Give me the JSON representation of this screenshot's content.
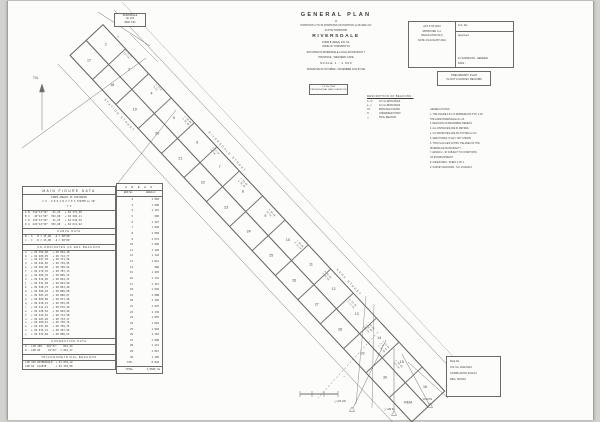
{
  "colors": {
    "ink": "#3a3a3a",
    "line": "#6b6b66",
    "paper": "#fcfcfa"
  },
  "title_block": {
    "main": "GENERAL  PLAN",
    "of": "of",
    "portions": "PORTIONS 2 TO 30 (PORTIONS OF PORTION 1) OF ERF 217",
    "in_the": "IN THE TOWNSHIP",
    "name": "RIVERSDALE",
    "sub1": "FORM B (AREA)  D.B. No.",
    "sub2": "ZONE OF TOWNSHIP 64",
    "situated": "SITUATED IN RIVERSDALE LOCAL MUNICIPALITY",
    "province": "PROVINCE :  WESTERN CAPE",
    "scale": "SCALE  1 : 1 000",
    "surveyed": "SURVEYED IN OCTOBER - NOVEMBER 2011 BY ME"
  },
  "surveyor_box": {
    "lines": [
      "L.S. No. 8106",
      "PROFESSIONAL LAND SURVEYOR"
    ]
  },
  "approval_box": {
    "left_lines": [
      "ACT 9 OF 2010",
      "APPROVED i.t.o.",
      "REGULATION 5(1)",
      "DATE: 19 AUGUST 2011"
    ],
    "sg_label": "S.G. No.",
    "approved_label": "Approved",
    "for_label": "for  SURVEYOR - GENERAL",
    "date_label": "DATE :"
  },
  "preliminary_box": {
    "lines": [
      "PRELIMINARY PLAN",
      "IS NOT A SURVEY RECORD"
    ]
  },
  "beacon_legend": {
    "title": "DESCRIPTION OF BEACONS :",
    "rows": [
      {
        "code": "A - D",
        "desc": "12 mm IRON PEGS"
      },
      {
        "code": "a - y",
        "desc": "12 mm IRON PEGS"
      },
      {
        "code": "I.P.",
        "desc": "IRON PEG FOUND"
      },
      {
        "code": "O",
        "desc": "UNMARKED POINT"
      },
      {
        "code": "△",
        "desc": "TRIG. BEACON"
      }
    ]
  },
  "notes": {
    "lines": [
      "GENERAL NOTES :",
      "1. THE FIGURE A B C D REPRESENTS PTN. 1 OF",
      "    THE FARM RIVERSDALE No. 64.",
      "2. BEACONS AS DESCRIBED HEREON.",
      "3. ALL DISTANCES ARE IN METRES.",
      "4. CO-ORDINATES ARE ON SYSTEM Lo 19°.",
      "5. SERVITUDES, IF ANY, NOT SHOWN.",
      "6. THIS PLAN LIES WITHIN THE AREA OF THE",
      "    RIVERSDALE MUNICIPALITY.",
      "7. ERVEN 2 - 30 SUBJECT TO CONDITIONS",
      "    OF ESTABLISHMENT.",
      "8. ANNEXURES : SHEET 2 OF 2.",
      "9. SURVEY RECORDS : S.R. 2011/0413."
    ]
  },
  "ref_box": {
    "lines": [
      "RIVERSDALE",
      "No. 100",
      "REM. 1/64"
    ]
  },
  "north_label": "T.N.",
  "main_table": {
    "title": "MAIN  FIGURE  DATA",
    "hdr1": "SIDES      ANGLES OF      DISTANCES",
    "hdr2": "C O - O R D I N A T E S    SYSTEM Lo 19°",
    "hdr3": "Y                        X",
    "sections": [
      {
        "header": null,
        "rows": [
          "A B  312°14'50\"   41,25   + 62 371,48",
          "B C   42°14'50\"  352,68   + 62 402,11",
          "C D  132°14'50\"   41,25   + 62 642,55",
          "D A  222°14'50\"  352,68   + 62 611,92"
        ]
      },
      {
        "header": "CURVE  DATA",
        "rows": [
          "B - b   R = 15,00   Δ = 90°00'",
          "c - C   R = 15,00   Δ = 90°00'"
        ]
      },
      {
        "header": "CO-ORDINATES OF ERF BEACONS",
        "rows": [
          "a   + 62 392,60   + 28 694,18",
          "b   + 62 409,95   + 28 712,77",
          "c   + 62 427,30   + 28 731,36",
          "d   + 62 444,65   + 28 749,95",
          "e   + 62 462,00   + 28 768,54",
          "f   + 62 479,35   + 28 787,13",
          "g   + 62 496,70   + 28 805,72",
          "h   + 62 514,05   + 28 824,31",
          "j   + 62 531,40   + 28 842,90",
          "k   + 62 548,75   + 28 861,49",
          "m   + 62 566,10   + 28 880,08",
          "n   + 62 583,45   + 28 898,67",
          "p   + 62 600,80   + 28 917,26",
          "q   + 62 618,15   + 28 935,85",
          "r   + 62 411,21   + 28 676,40",
          "s   + 62 428,56   + 28 694,99",
          "t   + 62 445,91   + 28 713,58",
          "u   + 62 463,26   + 28 732,17",
          "v   + 62 480,61   + 28 750,76",
          "w   + 62 497,96   + 28 769,35",
          "x   + 62 515,31   + 28 787,94",
          "y   + 62 532,66   + 28 806,53"
        ]
      },
      {
        "header": "CONNECTION  DATA",
        "rows": [
          "A - L1B 100   221°37'    812,44",
          "D - L2B 64     41°52'  1 043,17"
        ]
      },
      {
        "header": "TRIGONOMETRICAL  BEACONS",
        "rows": [
          "L1B 100 RIVERSDALE  + 61 834,12",
          "L2B 64  VLAKTE      + 63 310,08"
        ]
      }
    ]
  },
  "areas_table": {
    "title": "A R E A S",
    "col1": "ERF No.",
    "col2": "AREA m²",
    "rows": [
      [
        "2",
        "1 083"
      ],
      [
        "3",
        "1 090"
      ],
      [
        "4",
        "1 115"
      ],
      [
        "5",
        "996"
      ],
      [
        "6",
        "1 227"
      ],
      [
        "7",
        "1 040"
      ],
      [
        "8",
        "1 058"
      ],
      [
        "9",
        "1 072"
      ],
      [
        "10",
        "1 096"
      ],
      [
        "11",
        "1 120"
      ],
      [
        "12",
        "1 144"
      ],
      [
        "13",
        "1 012"
      ],
      [
        "14",
        "986"
      ],
      [
        "15",
        "1 203"
      ],
      [
        "16",
        "1 131"
      ],
      [
        "17",
        "1 167"
      ],
      [
        "18",
        "1 049"
      ],
      [
        "19",
        "1 088"
      ],
      [
        "20",
        "1 102"
      ],
      [
        "21",
        "1 076"
      ],
      [
        "22",
        "1 139"
      ],
      [
        "23",
        "1 055"
      ],
      [
        "24",
        "1 018"
      ],
      [
        "25",
        "1 094"
      ],
      [
        "26",
        "1 162"
      ],
      [
        "27",
        "1 008"
      ],
      [
        "28",
        "1 121"
      ],
      [
        "29",
        "1 067"
      ],
      [
        "30",
        "1 185"
      ],
      [
        "STR.",
        "8 044"
      ]
    ],
    "total_label": "TOTAL",
    "total_value": "3,9596 ha"
  },
  "band": {
    "lots_top": [
      "2",
      "3",
      "4",
      "5",
      "6",
      "7",
      "8",
      "9",
      "10",
      "11",
      "12",
      "13",
      "14",
      "15",
      "16"
    ],
    "lots_bottom": [
      "17",
      "18",
      "19",
      "20",
      "21",
      "22",
      "23",
      "24",
      "25",
      "26",
      "27",
      "28",
      "29",
      "30",
      "REM"
    ],
    "streets": [
      {
        "label": "RIVERSDALE   STREET",
        "x": 150,
        "t": -7
      },
      {
        "label": "KERK   STREET",
        "x": 338,
        "t": -7
      },
      {
        "label": "STATION   STREET",
        "x": 55,
        "t": 47
      }
    ]
  },
  "clusters": [
    {
      "x": 118,
      "y": 36,
      "r": 47,
      "lines": [
        "A"
      ]
    },
    {
      "x": 126,
      "y": 50,
      "r": 47,
      "lines": [
        "B 41,25",
        "312°14'"
      ]
    },
    {
      "x": 156,
      "y": 84,
      "r": 47,
      "lines": [
        "a 12,0",
        "9,14"
      ]
    },
    {
      "x": 185,
      "y": 116,
      "r": 47,
      "lines": [
        "c 30,48",
        "d 30,48"
      ]
    },
    {
      "x": 213,
      "y": 147,
      "r": 47,
      "lines": [
        "e 15,24",
        "24°10'"
      ]
    },
    {
      "x": 241,
      "y": 178,
      "r": 47,
      "lines": [
        "f 30,48",
        "g 30,48"
      ]
    },
    {
      "x": 269,
      "y": 209,
      "r": 47,
      "lines": [
        "h 30,48",
        "42°14'"
      ]
    },
    {
      "x": 297,
      "y": 240,
      "r": 47,
      "lines": [
        "j 30,48",
        "k 15,24"
      ]
    },
    {
      "x": 325,
      "y": 271,
      "r": 47,
      "lines": [
        "m 30,48",
        "n 30,48"
      ]
    },
    {
      "x": 350,
      "y": 299,
      "r": 47,
      "lines": [
        "p 24,38",
        "q 12,19"
      ]
    },
    {
      "x": 368,
      "y": 322,
      "r": 47,
      "lines": [
        "r 30,48",
        "s 30,48",
        "132°14'"
      ]
    },
    {
      "x": 383,
      "y": 341,
      "r": 47,
      "lines": [
        "t 12,19",
        "I.P. 41",
        "u 24,38"
      ]
    },
    {
      "x": 396,
      "y": 360,
      "r": 47,
      "lines": [
        "v 30,48",
        "222°14'"
      ]
    },
    {
      "x": 344,
      "y": 376,
      "r": 47,
      "lines": [
        "C"
      ]
    }
  ],
  "trig_beacons": [
    {
      "x": 334,
      "y": 400,
      "label": "△ L1B 100"
    },
    {
      "x": 384,
      "y": 408,
      "label": "△ L2B 64"
    },
    {
      "x": 420,
      "y": 398,
      "label": "△ VLAKTE"
    }
  ],
  "file_box": {
    "lines": [
      "FILE No.",
      "S.R. No. 2011/0413",
      "COMPILATION  2011.03",
      "DRG.  RV/64/1"
    ]
  }
}
